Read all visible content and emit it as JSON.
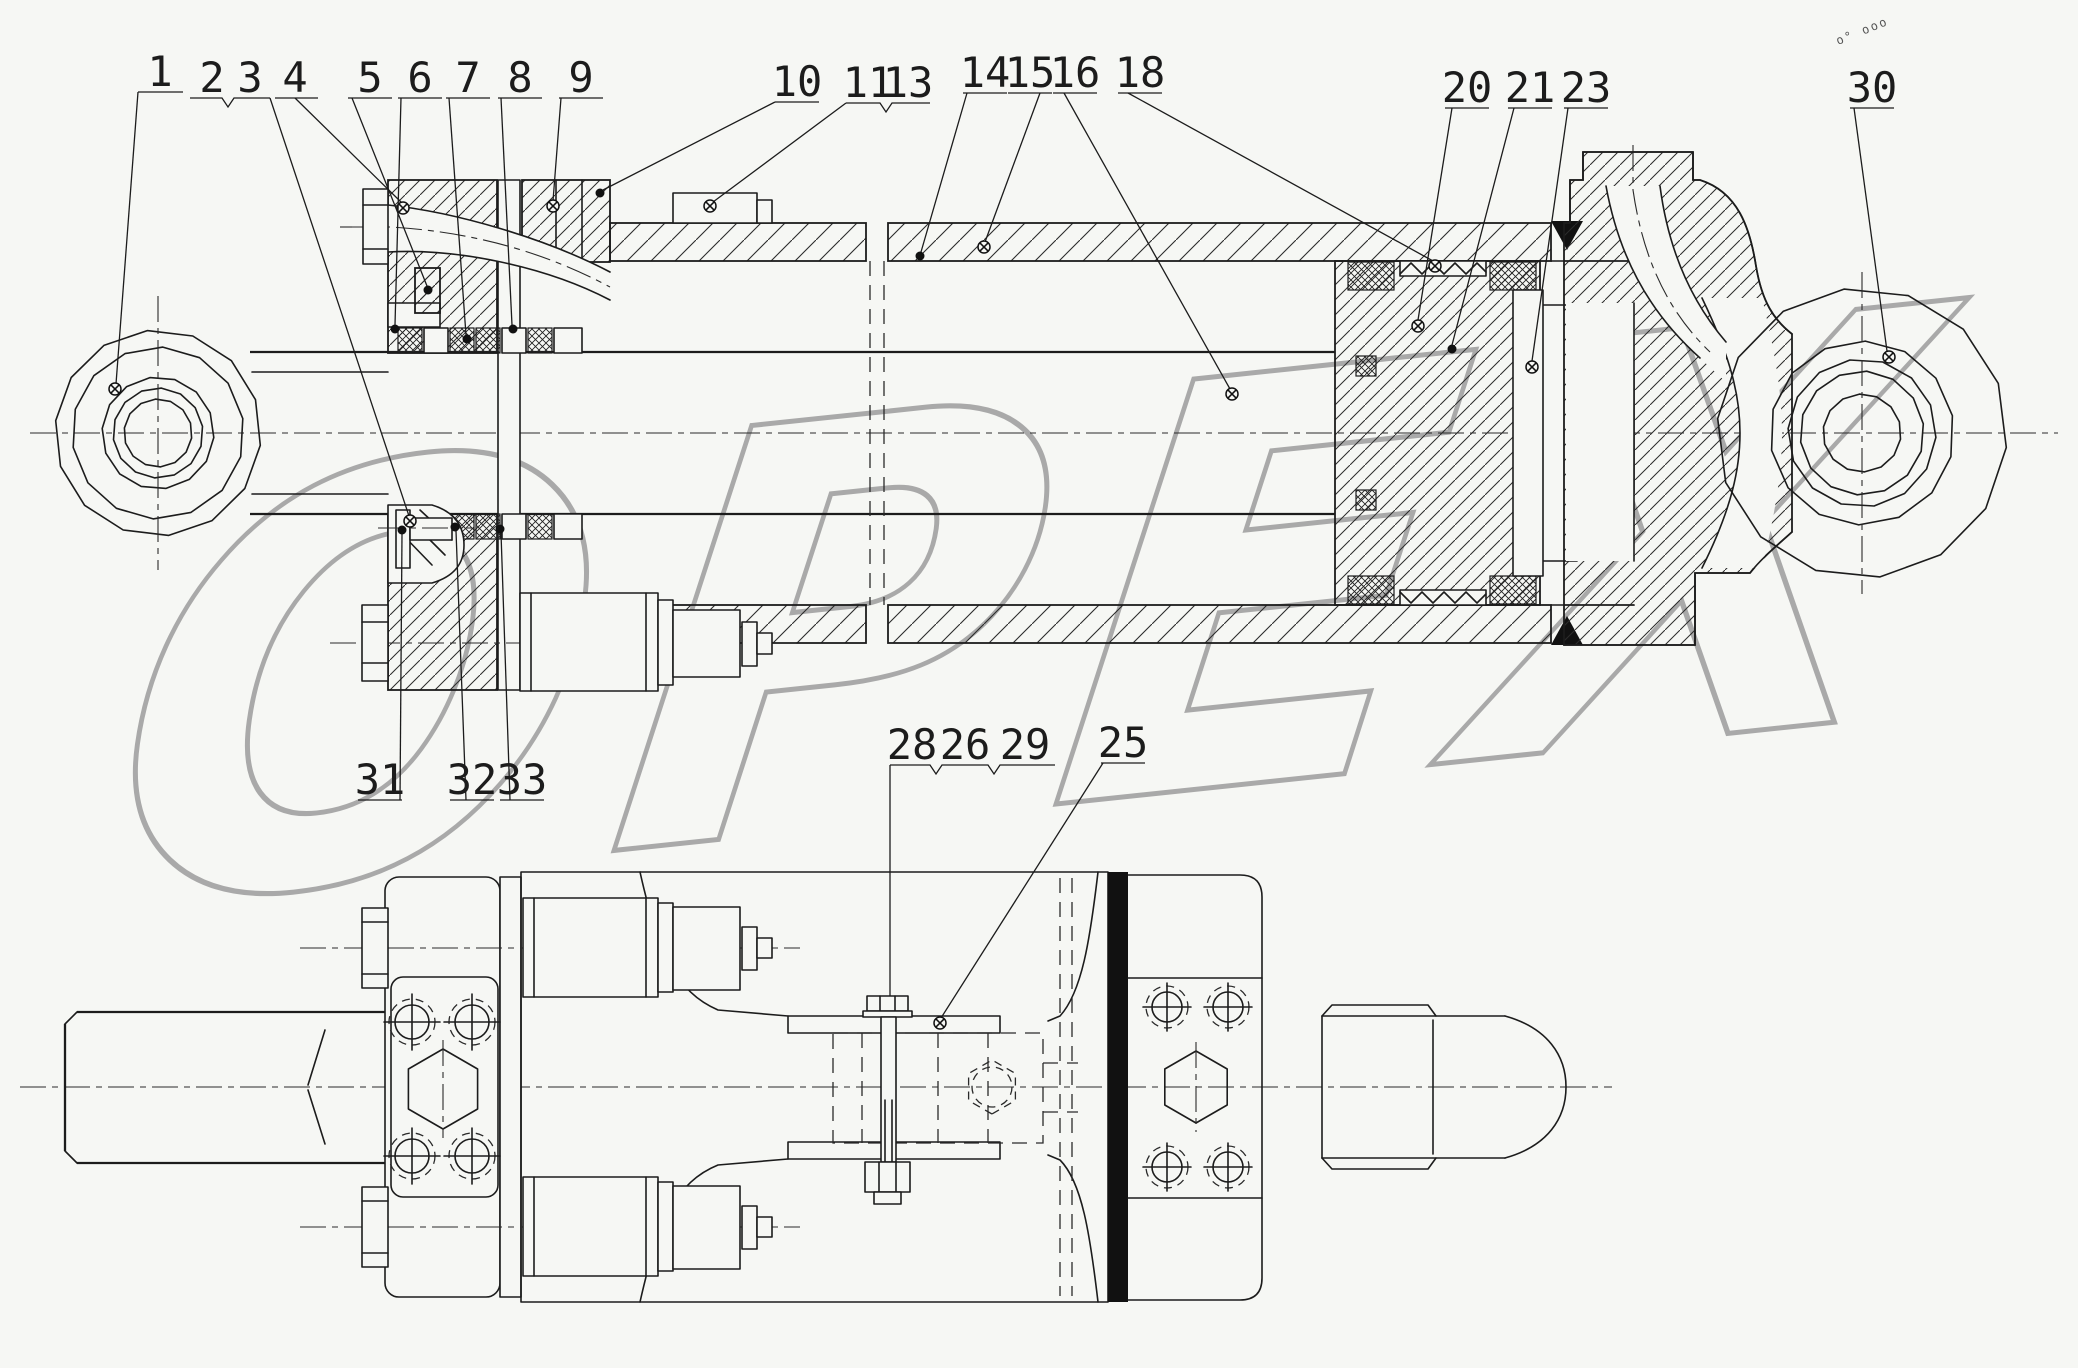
{
  "drawing": {
    "type": "technical-assembly-drawing",
    "subject": "hydraulic cylinder assembly, sectional view and bottom view",
    "paper_color": "#f6f7f4",
    "line_color": "#1c1c1c"
  },
  "watermark": {
    "text": "OPEX",
    "color": "#a9a9a9"
  },
  "stamp": {
    "text": "o° ooo"
  },
  "callouts": [
    {
      "n": "1",
      "x": 160,
      "y": 86,
      "lines": [
        [
          [
            138,
            92
          ],
          [
            183,
            92
          ]
        ],
        [
          [
            138,
            92
          ],
          [
            116,
            384
          ]
        ]
      ],
      "marker": {
        "t": "target",
        "x": 115,
        "y": 389
      }
    },
    {
      "n": "2",
      "x": 212,
      "y": 92,
      "lines": [
        [
          [
            190,
            98
          ],
          [
            222,
            98
          ],
          [
            228,
            107
          ],
          [
            234,
            98
          ],
          [
            270,
            98
          ]
        ],
        [
          [
            270,
            98
          ],
          [
            409,
            516
          ]
        ]
      ],
      "marker": {
        "t": "target",
        "x": 410,
        "y": 521
      }
    },
    {
      "n": "3",
      "x": 250,
      "y": 92
    },
    {
      "n": "4",
      "x": 295,
      "y": 92,
      "lines": [
        [
          [
            275,
            98
          ],
          [
            318,
            98
          ]
        ],
        [
          [
            295,
            98
          ],
          [
            402,
            203
          ]
        ]
      ],
      "marker": {
        "t": "target",
        "x": 403,
        "y": 208
      }
    },
    {
      "n": "5",
      "x": 370,
      "y": 92,
      "lines": [
        [
          [
            348,
            98
          ],
          [
            392,
            98
          ]
        ],
        [
          [
            352,
            98
          ],
          [
            427,
            286
          ]
        ]
      ],
      "marker": {
        "t": "dot",
        "x": 428,
        "y": 290
      }
    },
    {
      "n": "6",
      "x": 420,
      "y": 92,
      "lines": [
        [
          [
            398,
            98
          ],
          [
            442,
            98
          ]
        ],
        [
          [
            401,
            98
          ],
          [
            395,
            325
          ]
        ]
      ],
      "marker": {
        "t": "dot",
        "x": 395,
        "y": 329
      }
    },
    {
      "n": "7",
      "x": 468,
      "y": 92,
      "lines": [
        [
          [
            446,
            98
          ],
          [
            490,
            98
          ]
        ],
        [
          [
            449,
            98
          ],
          [
            466,
            335
          ]
        ]
      ],
      "marker": {
        "t": "dot",
        "x": 467,
        "y": 339
      }
    },
    {
      "n": "8",
      "x": 520,
      "y": 92,
      "lines": [
        [
          [
            498,
            98
          ],
          [
            542,
            98
          ]
        ],
        [
          [
            501,
            98
          ],
          [
            512,
            325
          ]
        ]
      ],
      "marker": {
        "t": "dot",
        "x": 513,
        "y": 329
      }
    },
    {
      "n": "9",
      "x": 581,
      "y": 92,
      "lines": [
        [
          [
            559,
            98
          ],
          [
            603,
            98
          ]
        ],
        [
          [
            561,
            98
          ],
          [
            553,
            201
          ]
        ]
      ],
      "marker": {
        "t": "target",
        "x": 553,
        "y": 206
      }
    },
    {
      "n": "10",
      "x": 797,
      "y": 96,
      "lines": [
        [
          [
            775,
            102
          ],
          [
            819,
            102
          ]
        ],
        [
          [
            775,
            102
          ],
          [
            603,
            190
          ]
        ]
      ],
      "marker": {
        "t": "dot",
        "x": 600,
        "y": 193
      }
    },
    {
      "n": "11",
      "x": 868,
      "y": 97,
      "lines": [
        [
          [
            846,
            103
          ],
          [
            880,
            103
          ],
          [
            886,
            112
          ],
          [
            892,
            103
          ],
          [
            930,
            103
          ]
        ],
        [
          [
            846,
            103
          ],
          [
            713,
            202
          ]
        ]
      ],
      "marker": {
        "t": "target",
        "x": 710,
        "y": 206
      }
    },
    {
      "n": "13",
      "x": 908,
      "y": 97
    },
    {
      "n": "14",
      "x": 985,
      "y": 87,
      "lines": [
        [
          [
            963,
            93
          ],
          [
            1007,
            93
          ]
        ],
        [
          [
            967,
            93
          ],
          [
            921,
            252
          ]
        ]
      ],
      "marker": {
        "t": "dot",
        "x": 920,
        "y": 256
      }
    },
    {
      "n": "15",
      "x": 1030,
      "y": 87,
      "lines": [
        [
          [
            1008,
            93
          ],
          [
            1052,
            93
          ]
        ],
        [
          [
            1040,
            93
          ],
          [
            985,
            242
          ]
        ]
      ],
      "marker": {
        "t": "target",
        "x": 984,
        "y": 247
      }
    },
    {
      "n": "16",
      "x": 1075,
      "y": 87,
      "lines": [
        [
          [
            1053,
            93
          ],
          [
            1097,
            93
          ]
        ],
        [
          [
            1064,
            93
          ],
          [
            1230,
            389
          ]
        ]
      ],
      "marker": {
        "t": "target",
        "x": 1232,
        "y": 394
      }
    },
    {
      "n": "18",
      "x": 1140,
      "y": 87,
      "lines": [
        [
          [
            1118,
            93
          ],
          [
            1162,
            93
          ]
        ],
        [
          [
            1128,
            93
          ],
          [
            1433,
            261
          ]
        ]
      ],
      "marker": {
        "t": "target",
        "x": 1435,
        "y": 266
      }
    },
    {
      "n": "20",
      "x": 1467,
      "y": 102,
      "lines": [
        [
          [
            1445,
            108
          ],
          [
            1489,
            108
          ]
        ],
        [
          [
            1452,
            108
          ],
          [
            1418,
            320
          ]
        ]
      ],
      "marker": {
        "t": "target",
        "x": 1418,
        "y": 326
      }
    },
    {
      "n": "21",
      "x": 1530,
      "y": 102,
      "lines": [
        [
          [
            1508,
            108
          ],
          [
            1552,
            108
          ]
        ],
        [
          [
            1514,
            108
          ],
          [
            1452,
            345
          ]
        ]
      ],
      "marker": {
        "t": "dot",
        "x": 1452,
        "y": 349
      }
    },
    {
      "n": "23",
      "x": 1586,
      "y": 102,
      "lines": [
        [
          [
            1564,
            108
          ],
          [
            1608,
            108
          ]
        ],
        [
          [
            1568,
            108
          ],
          [
            1532,
            361
          ]
        ]
      ],
      "marker": {
        "t": "target",
        "x": 1532,
        "y": 367
      }
    },
    {
      "n": "30",
      "x": 1872,
      "y": 102,
      "lines": [
        [
          [
            1850,
            108
          ],
          [
            1894,
            108
          ]
        ],
        [
          [
            1854,
            108
          ],
          [
            1887,
            351
          ]
        ]
      ],
      "marker": {
        "t": "target",
        "x": 1889,
        "y": 357
      }
    },
    {
      "n": "31",
      "x": 380,
      "y": 794,
      "lines": [
        [
          [
            358,
            800
          ],
          [
            402,
            800
          ]
        ],
        [
          [
            400,
            800
          ],
          [
            402,
            534
          ]
        ]
      ],
      "marker": {
        "t": "dot",
        "x": 402,
        "y": 530
      }
    },
    {
      "n": "32",
      "x": 472,
      "y": 794,
      "lines": [
        [
          [
            450,
            800
          ],
          [
            494,
            800
          ]
        ],
        [
          [
            466,
            800
          ],
          [
            456,
            531
          ]
        ]
      ],
      "marker": {
        "t": "dot",
        "x": 455,
        "y": 527
      }
    },
    {
      "n": "33",
      "x": 522,
      "y": 794,
      "lines": [
        [
          [
            500,
            800
          ],
          [
            544,
            800
          ]
        ],
        [
          [
            510,
            800
          ],
          [
            501,
            533
          ]
        ]
      ],
      "marker": {
        "t": "dot",
        "x": 500,
        "y": 529
      }
    },
    {
      "n": "28",
      "x": 912,
      "y": 759,
      "lines": [
        [
          [
            890,
            765
          ],
          [
            930,
            765
          ],
          [
            936,
            774
          ],
          [
            942,
            765
          ],
          [
            988,
            765
          ],
          [
            994,
            774
          ],
          [
            1000,
            765
          ],
          [
            1055,
            765
          ]
        ],
        [
          [
            890,
            765
          ],
          [
            890,
            996
          ]
        ]
      ]
    },
    {
      "n": "26",
      "x": 965,
      "y": 759
    },
    {
      "n": "29",
      "x": 1025,
      "y": 759
    },
    {
      "n": "25",
      "x": 1123,
      "y": 757,
      "lines": [
        [
          [
            1101,
            763
          ],
          [
            1145,
            763
          ]
        ],
        [
          [
            1103,
            763
          ],
          [
            941,
            1018
          ]
        ]
      ],
      "marker": {
        "t": "target",
        "x": 940,
        "y": 1023
      }
    }
  ]
}
